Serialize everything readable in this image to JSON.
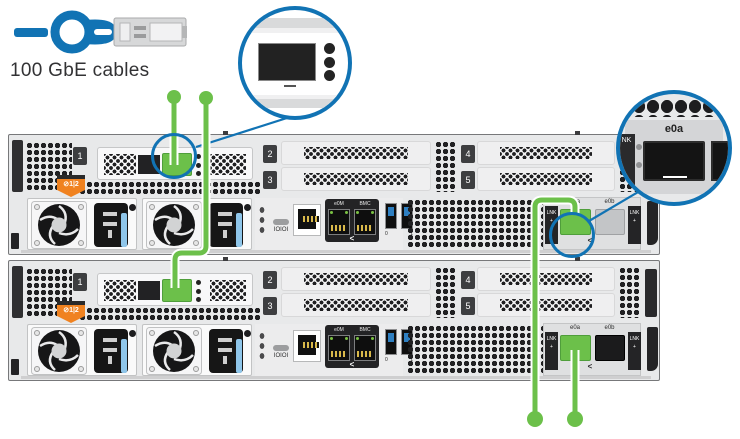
{
  "colors": {
    "accent_blue": "#1173b4",
    "cable_green": "#6cc04a",
    "warning_orange": "#f08220",
    "psu_tab_blue": "#8fc6ea",
    "usb_blue": "#2e7fc1"
  },
  "legend": {
    "label": "100 GbE cables"
  },
  "callout_e0a": {
    "port_label": "e0a",
    "link_text_partial": "NK"
  },
  "chassis": {
    "slots": [
      "1",
      "2",
      "3",
      "4",
      "5"
    ],
    "warning_icon": "⊘",
    "warning_label": "1|2",
    "serial_label": "IOIOI",
    "mgmt_ports": {
      "a": "e0M",
      "b": "BMC"
    },
    "usb_labels": [
      "0",
      "1"
    ],
    "lan_icon": "<",
    "onboard": {
      "link_label": "LNK",
      "plus_label": "+",
      "e0a_label": "e0a",
      "e0b_label": "e0b"
    }
  }
}
